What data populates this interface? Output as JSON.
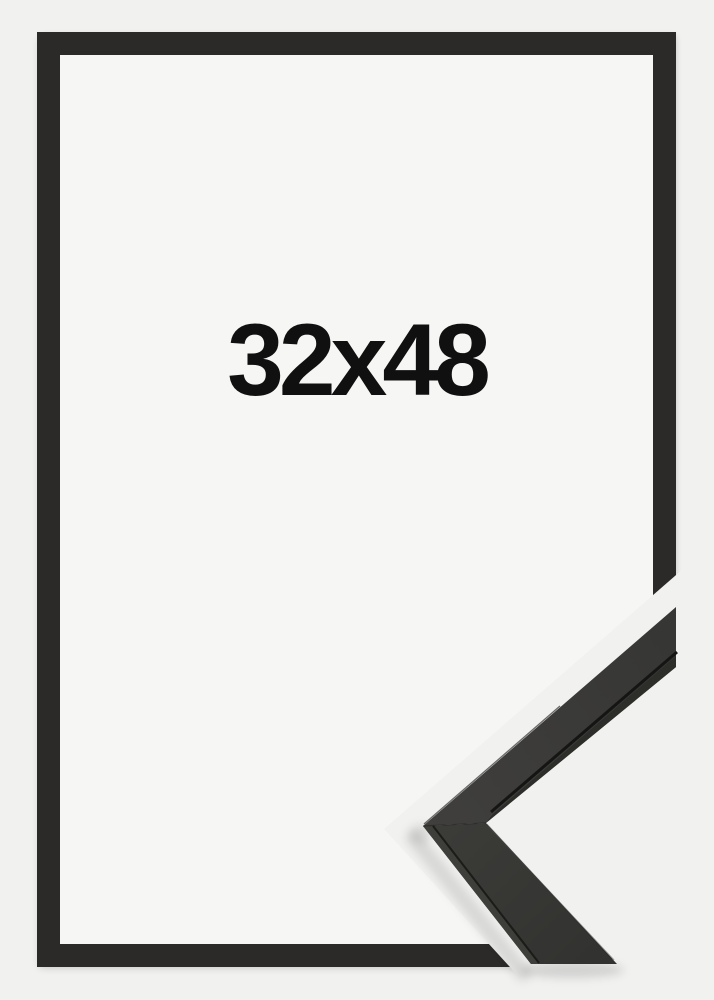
{
  "product": {
    "size_label": "32x48"
  },
  "image_parts": {
    "frame_description": "black picture frame front view",
    "corner_detail_description": "frame moulding corner profile sample"
  },
  "colors": {
    "background": "#f1f1ef",
    "interior": "#f6f6f4",
    "frame": "#232221",
    "text": "#101010",
    "sample_face_upper": "#3d3d3a",
    "sample_face_lower": "#373734",
    "sample_side": "#2d2d2a",
    "sample_side_lower": "#3e3e3b",
    "sample_groove": "#151513",
    "sample_highlight": "#51514d"
  }
}
